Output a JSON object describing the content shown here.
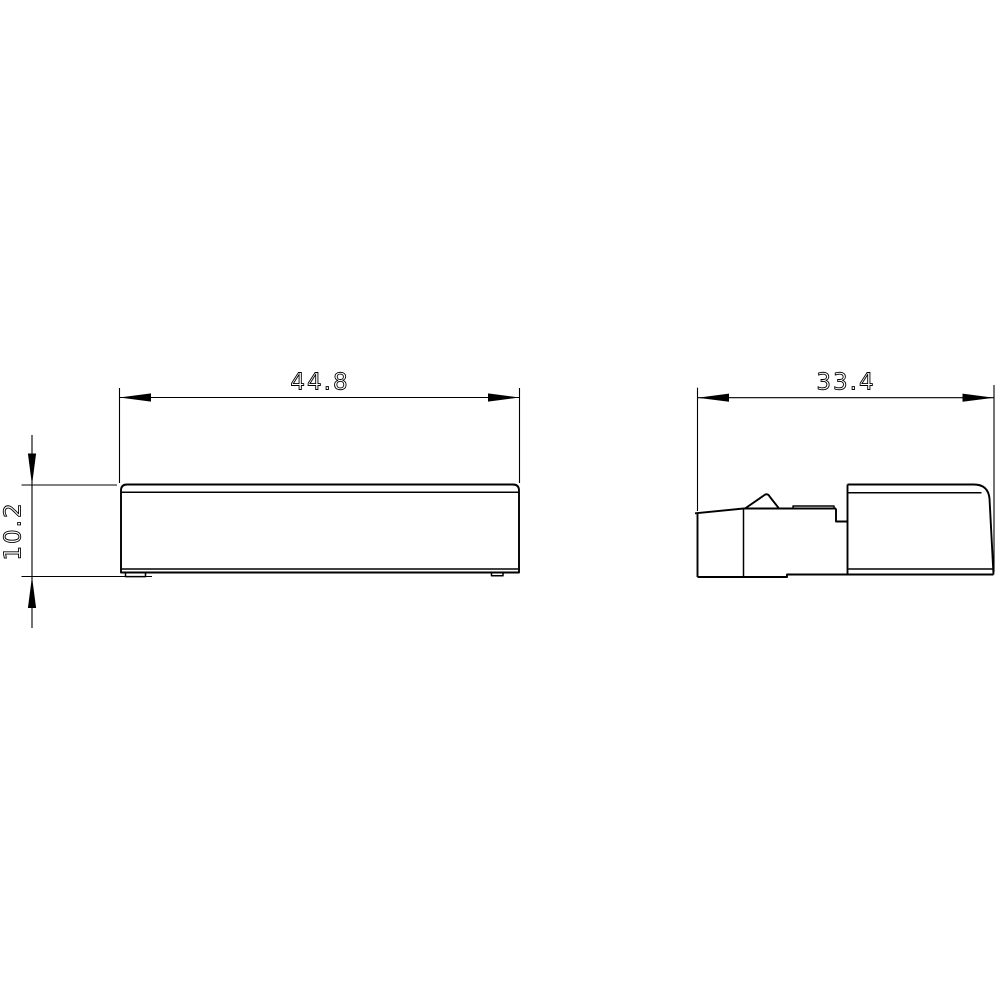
{
  "drawing": {
    "dimensions": {
      "front_width_label": "44.8",
      "side_depth_label": "33.4",
      "height_label": "10.2"
    },
    "style": {
      "line_color": "#000000",
      "background_color": "#ffffff"
    }
  }
}
